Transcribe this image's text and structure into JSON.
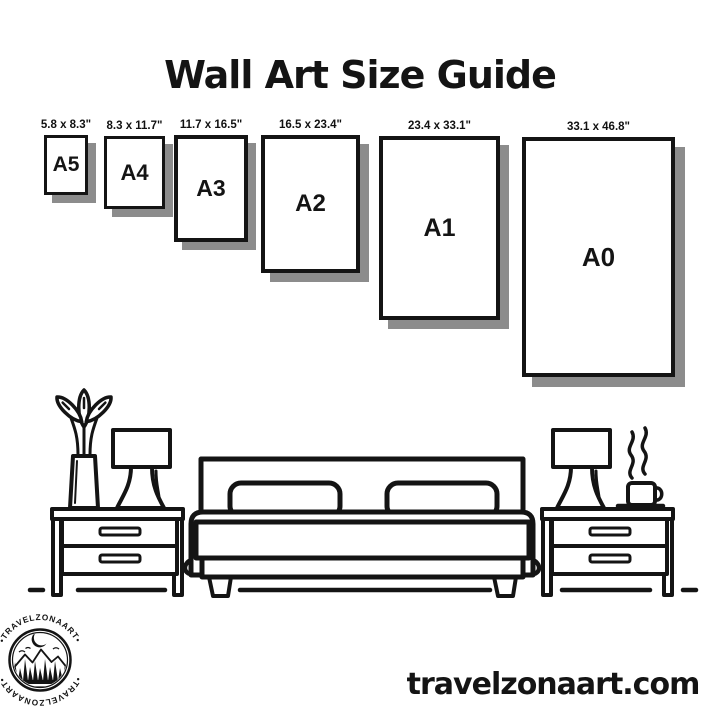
{
  "colors": {
    "ink": "#141414",
    "shadow": "#8c8c8c",
    "background": "#ffffff"
  },
  "header": {
    "title": "Wall Art Size Guide"
  },
  "size_guide": {
    "frames": [
      {
        "code": "A5",
        "dimensions": "5.8 x 8.3\""
      },
      {
        "code": "A4",
        "dimensions": "8.3 x 11.7\""
      },
      {
        "code": "A3",
        "dimensions": "11.7 x 16.5\""
      },
      {
        "code": "A2",
        "dimensions": "16.5 x 23.4\""
      },
      {
        "code": "A1",
        "dimensions": "23.4 x 33.1\""
      },
      {
        "code": "A0",
        "dimensions": "33.1 x 46.8\""
      }
    ]
  },
  "illustration": {
    "elements": [
      "plant-vase",
      "table-lamp-left",
      "nightstand-left",
      "bed-with-pillows",
      "nightstand-right",
      "table-lamp-right",
      "steaming-coffee-cup",
      "floor-line"
    ]
  },
  "footer": {
    "website": "travelzonaart.com",
    "logo": {
      "text_top": "•TRAVELZONAART•",
      "text_bottom": "•TRAVELZONAART•"
    }
  }
}
